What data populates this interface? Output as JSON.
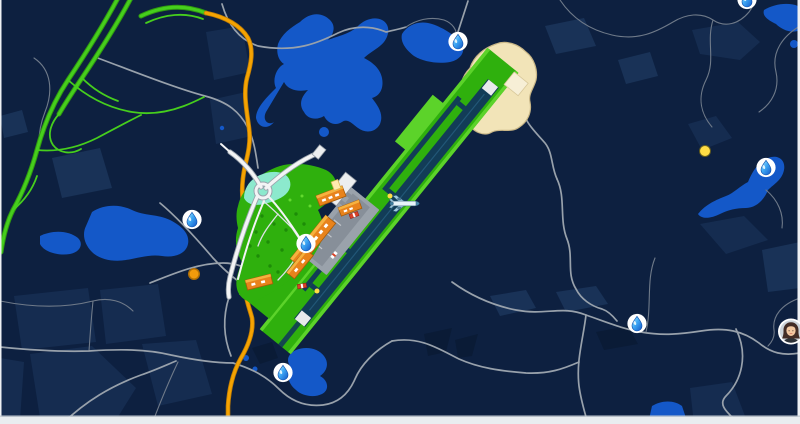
{
  "map": {
    "width": 800,
    "height": 424,
    "viewbox": "0 0 800 424",
    "description_labels": {},
    "colors": {
      "bg": "#0d2040",
      "district": "#152c50",
      "district2": "#193257",
      "forest": "#0a1b36",
      "water": "#1458c8",
      "road": "#98a1ab",
      "roadThin": "#6f7a89",
      "whiteRoad": "#f3f4f5",
      "whiteRoadCasing": "#9aa3ad",
      "highway": "#46ce1d",
      "highwayDark": "#2f9a10",
      "orangeRoad": "#f5a302",
      "orangeDark": "#bf7c04",
      "grass": "#2fb00d",
      "grassLight": "#5cd32a",
      "mint": "#8ce9cd",
      "sand": "#f2e4b8",
      "sandEdge": "#c9b787",
      "runway": "#123c57",
      "apron": "#9aa2ab",
      "apronDark": "#878f99",
      "terminal": "#eceef0",
      "bOrange": "#e8831c",
      "bOrangeDark": "#a85b08",
      "vehicleRed": "#d84128",
      "dotYellow": "#ffdd45",
      "dotOrange": "#f29b0c",
      "frame": "#eef1f4",
      "dropBlue": "#1257c8",
      "dropLight": "#b5ecfb"
    },
    "markers": [
      {
        "type": "water-drop",
        "x": 458,
        "y": 44
      },
      {
        "type": "water-drop",
        "x": 192,
        "y": 222
      },
      {
        "type": "water-drop",
        "x": 306,
        "y": 246
      },
      {
        "type": "water-drop",
        "x": 283,
        "y": 375
      },
      {
        "type": "water-drop",
        "x": 637,
        "y": 326
      },
      {
        "type": "water-drop",
        "x": 766,
        "y": 170
      },
      {
        "type": "water-drop",
        "x": 747,
        "y": 2
      },
      {
        "type": "yellow-dot",
        "x": 705,
        "y": 151
      },
      {
        "type": "yellow-dot-small",
        "x": 390,
        "y": 196
      },
      {
        "type": "yellow-dot-small",
        "x": 317,
        "y": 291
      },
      {
        "type": "orange-dot",
        "x": 194,
        "y": 274
      },
      {
        "type": "aircraft",
        "x": 404,
        "y": 206
      },
      {
        "type": "avatar",
        "x": 791,
        "y": 334
      }
    ]
  }
}
